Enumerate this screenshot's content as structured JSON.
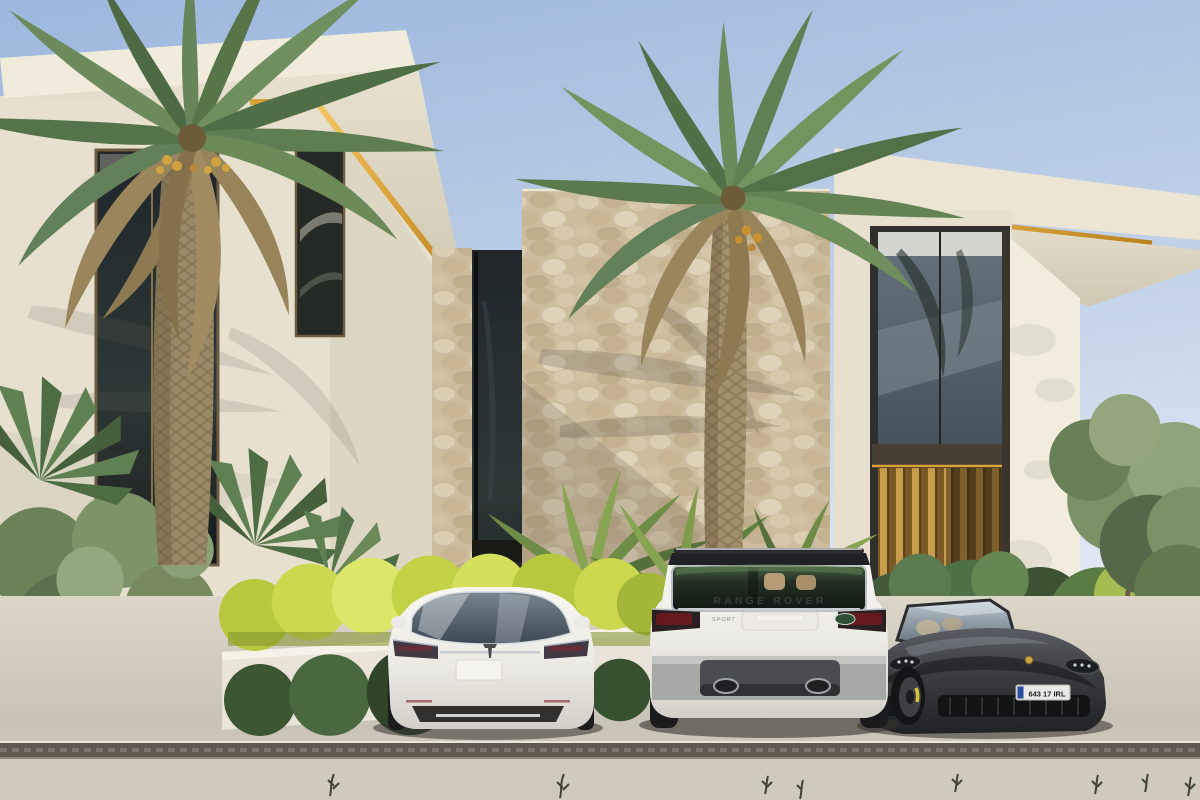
{
  "vehicles": {
    "range_rover": {
      "tailgate_text": "RANGE ROVER",
      "badge_text": "SPORT"
    },
    "porsche": {
      "license_plate": "643 17 IRL"
    },
    "tesla": {
      "license_plate": ""
    }
  },
  "palette": {
    "sky_top": "#9db7dd",
    "sky_horizon": "#e9eff6",
    "wall_cream": "#ece5d4",
    "wall_shade": "#d9d2bf",
    "accent_gold": "#d9a23b",
    "stone_beige": "#cdbd9f",
    "foliage_green": "#5f7d52",
    "foliage_dry": "#9a8760",
    "hedge_yellow": "#c9d84e",
    "hedge_dark": "#46603c",
    "pavement": "#cdc7ba",
    "drain": "#5f594f",
    "car_white": "#f3f2ee",
    "car_charcoal": "#3a3c40",
    "glass_dark": "#2a3238",
    "interior_warm": "#c49a4a",
    "plate_blue": "#2a4da0",
    "taillight_red": "#6e1a1f"
  }
}
